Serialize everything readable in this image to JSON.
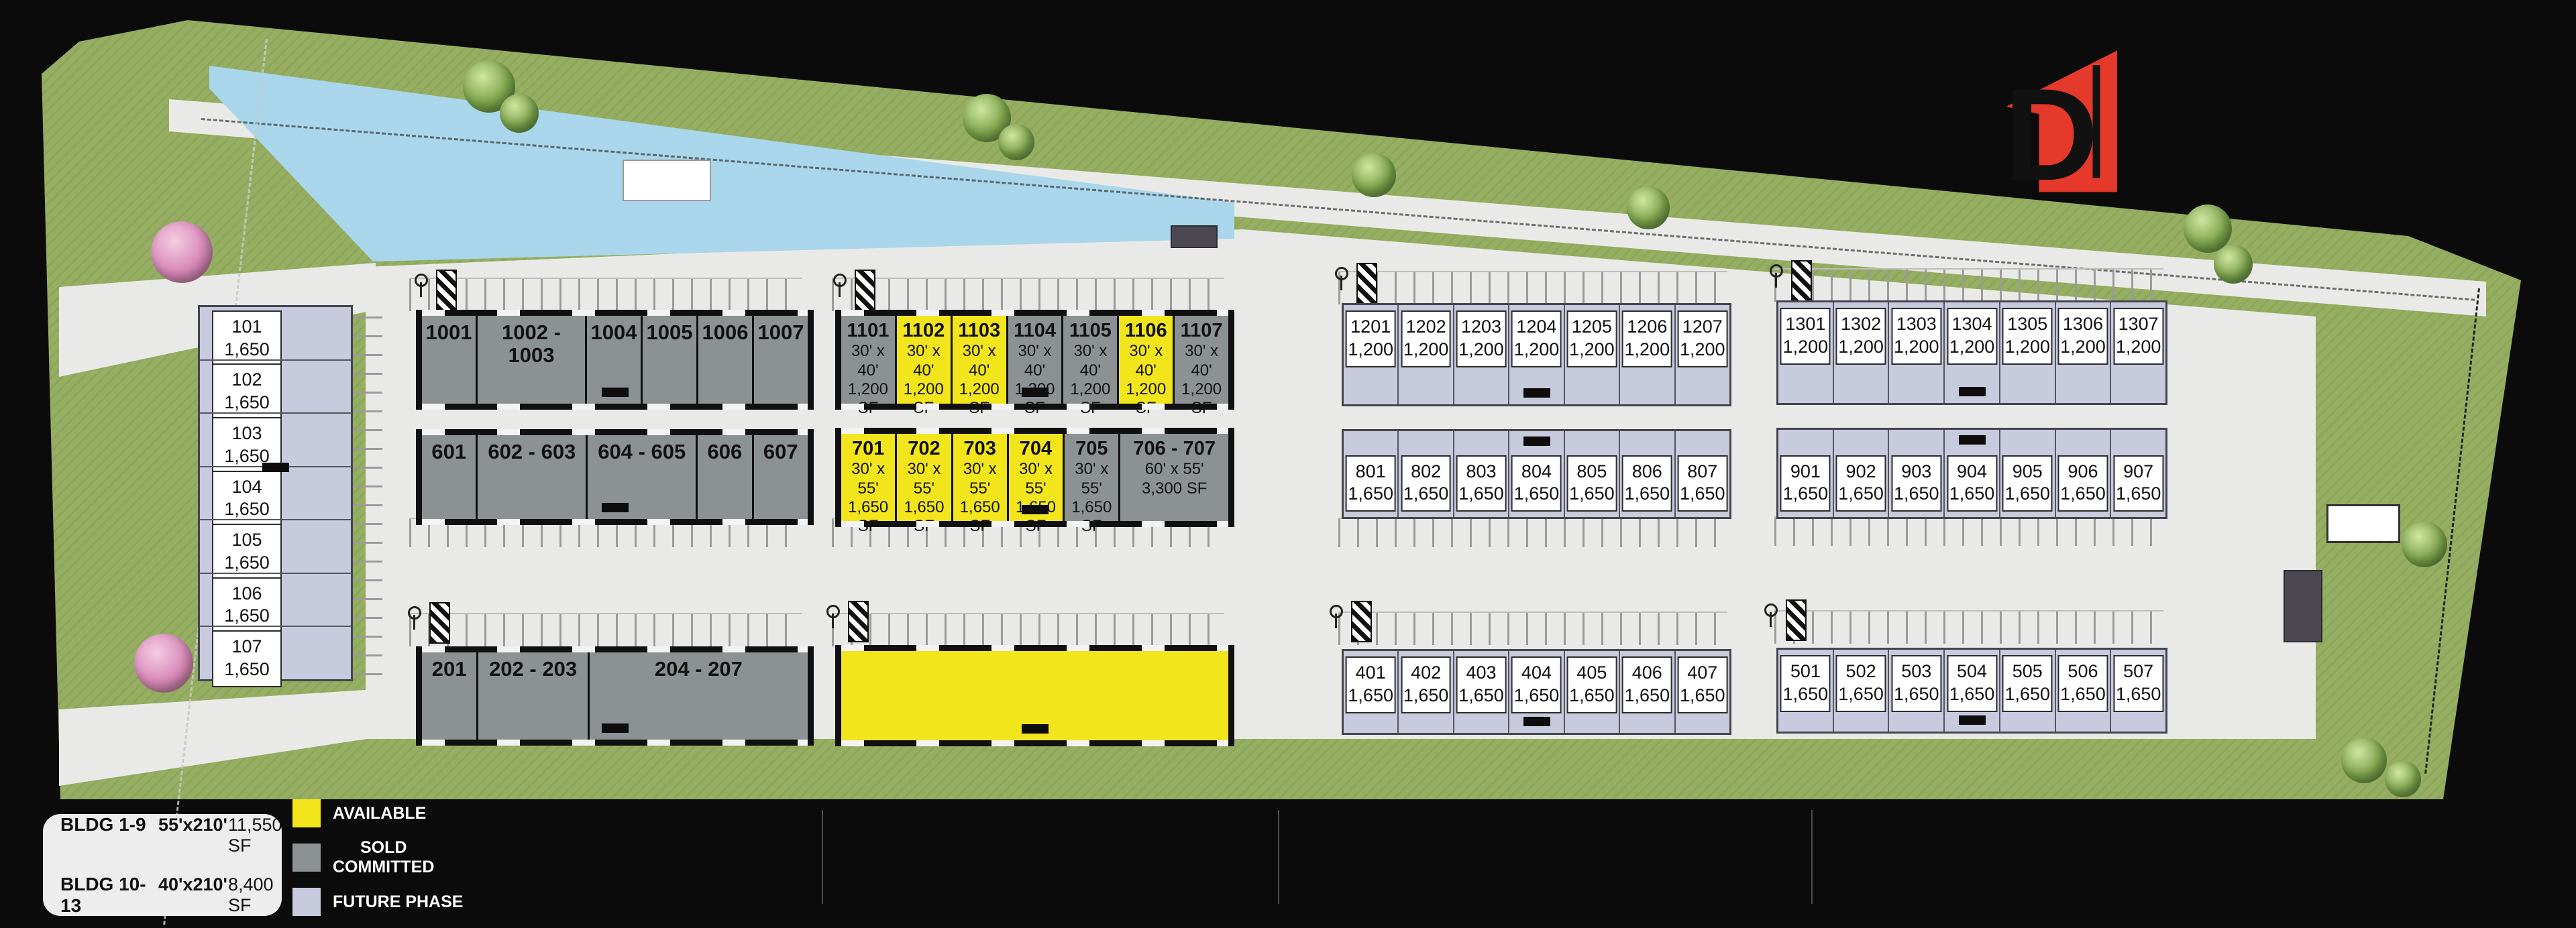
{
  "brand": {
    "name": "DACY",
    "subtitle": "Business Park"
  },
  "labels": {
    "pond": "POND",
    "street": "DACY LANE",
    "ossf": "OSSF",
    "sold_out": "SOLD OUT"
  },
  "legend": {
    "rows": [
      {
        "bldg": "BLDG 1-9",
        "dims": "55'x210'",
        "sf": "11,550 SF"
      },
      {
        "bldg": "BLDG 10-13",
        "dims": "40'x210'",
        "sf": "8,400 SF"
      }
    ],
    "statuses": [
      {
        "label": "AVAILABLE",
        "color": "#f2e51c"
      },
      {
        "label": "SOLD\nCOMMITTED",
        "color": "#8c9193"
      },
      {
        "label": "FUTURE PHASE",
        "color": "#c8cade"
      }
    ]
  },
  "phases": [
    {
      "name": "Phase 1",
      "status": "SOLD OUT"
    },
    {
      "name": "Phase 2",
      "status": "AVAILABLE"
    },
    {
      "name": "Phase 3",
      "status": "Q3 2026"
    },
    {
      "name": "Phase 4",
      "status": "Q1 2027"
    }
  ],
  "buildings": {
    "b1": {
      "label": "BLDG 1",
      "units": [
        {
          "num": "101",
          "sf": "1,650"
        },
        {
          "num": "102",
          "sf": "1,650"
        },
        {
          "num": "103",
          "sf": "1,650"
        },
        {
          "num": "104",
          "sf": "1,650"
        },
        {
          "num": "105",
          "sf": "1,650"
        },
        {
          "num": "106",
          "sf": "1,650"
        },
        {
          "num": "107",
          "sf": "1,650"
        }
      ]
    },
    "b10": {
      "label": "BLDG 10",
      "units": [
        {
          "num": "1001",
          "span": 1
        },
        {
          "num": "1002 - 1003",
          "span": 2
        },
        {
          "num": "1004",
          "span": 1
        },
        {
          "num": "1005",
          "span": 1
        },
        {
          "num": "1006",
          "span": 1
        },
        {
          "num": "1007",
          "span": 1
        }
      ]
    },
    "b11": {
      "label": "BLDG 11",
      "units": [
        {
          "num": "1101",
          "dims": "30' x 40'",
          "sf": "1,200 SF",
          "status": "sold"
        },
        {
          "num": "1102",
          "dims": "30' x 40'",
          "sf": "1,200 SF",
          "status": "avail"
        },
        {
          "num": "1103",
          "dims": "30' x 40'",
          "sf": "1,200 SF",
          "status": "avail"
        },
        {
          "num": "1104",
          "dims": "30' x 40'",
          "sf": "1,200 SF",
          "status": "sold"
        },
        {
          "num": "1105",
          "dims": "30' x 40'",
          "sf": "1,200 SF",
          "status": "sold"
        },
        {
          "num": "1106",
          "dims": "30' x 40'",
          "sf": "1,200 SF",
          "status": "avail"
        },
        {
          "num": "1107",
          "dims": "30' x 40'",
          "sf": "1,200 SF",
          "status": "sold"
        }
      ]
    },
    "b12": {
      "label": "BLDG 12",
      "units": [
        {
          "num": "1201",
          "sf": "1,200"
        },
        {
          "num": "1202",
          "sf": "1,200"
        },
        {
          "num": "1203",
          "sf": "1,200"
        },
        {
          "num": "1204",
          "sf": "1,200"
        },
        {
          "num": "1205",
          "sf": "1,200"
        },
        {
          "num": "1206",
          "sf": "1,200"
        },
        {
          "num": "1207",
          "sf": "1,200"
        }
      ]
    },
    "b13": {
      "label": "BLDG 13",
      "units": [
        {
          "num": "1301",
          "sf": "1,200"
        },
        {
          "num": "1302",
          "sf": "1,200"
        },
        {
          "num": "1303",
          "sf": "1,200"
        },
        {
          "num": "1304",
          "sf": "1,200"
        },
        {
          "num": "1305",
          "sf": "1,200"
        },
        {
          "num": "1306",
          "sf": "1,200"
        },
        {
          "num": "1307",
          "sf": "1,200"
        }
      ]
    },
    "b6": {
      "label": "BLDG 6",
      "units": [
        {
          "num": "601",
          "span": 1
        },
        {
          "num": "602 - 603",
          "span": 2
        },
        {
          "num": "604 - 605",
          "span": 2
        },
        {
          "num": "606",
          "span": 1
        },
        {
          "num": "607",
          "span": 1
        }
      ]
    },
    "b7": {
      "label": "BLDG 7",
      "units": [
        {
          "num": "701",
          "dims": "30' x 55'",
          "sf": "1,650 SF",
          "status": "avail"
        },
        {
          "num": "702",
          "dims": "30' x 55'",
          "sf": "1,650 SF",
          "status": "avail"
        },
        {
          "num": "703",
          "dims": "30' x 55'",
          "sf": "1,650 SF",
          "status": "avail"
        },
        {
          "num": "704",
          "dims": "30' x 55'",
          "sf": "1,650 SF",
          "status": "avail"
        },
        {
          "num": "705",
          "dims": "30' x 55'",
          "sf": "1,650 SF",
          "status": "sold"
        },
        {
          "num": "706 - 707",
          "dims": "60' x 55'",
          "sf": "3,300 SF",
          "status": "sold",
          "span": 2
        }
      ]
    },
    "b8": {
      "label": "BLDG 8",
      "units": [
        {
          "num": "801",
          "sf": "1,650"
        },
        {
          "num": "802",
          "sf": "1,650"
        },
        {
          "num": "803",
          "sf": "1,650"
        },
        {
          "num": "804",
          "sf": "1,650"
        },
        {
          "num": "805",
          "sf": "1,650"
        },
        {
          "num": "806",
          "sf": "1,650"
        },
        {
          "num": "807",
          "sf": "1,650"
        }
      ]
    },
    "b9": {
      "label": "BLDG 9",
      "units": [
        {
          "num": "901",
          "sf": "1,650"
        },
        {
          "num": "902",
          "sf": "1,650"
        },
        {
          "num": "903",
          "sf": "1,650"
        },
        {
          "num": "904",
          "sf": "1,650"
        },
        {
          "num": "905",
          "sf": "1,650"
        },
        {
          "num": "906",
          "sf": "1,650"
        },
        {
          "num": "907",
          "sf": "1,650"
        }
      ]
    },
    "b2": {
      "label": "BLDG 2",
      "units": [
        {
          "num": "201",
          "span": 1
        },
        {
          "num": "202 - 203",
          "span": 2
        },
        {
          "num": "204 - 207",
          "span": 4
        }
      ]
    },
    "b3": {
      "label": "BLDG 3",
      "range": "301 - 307",
      "dims": "210' x 55'",
      "sf": "11,550 SF"
    },
    "b4": {
      "label": "BLDG 4",
      "units": [
        {
          "num": "401",
          "sf": "1,650"
        },
        {
          "num": "402",
          "sf": "1,650"
        },
        {
          "num": "403",
          "sf": "1,650"
        },
        {
          "num": "404",
          "sf": "1,650"
        },
        {
          "num": "405",
          "sf": "1,650"
        },
        {
          "num": "406",
          "sf": "1,650"
        },
        {
          "num": "407",
          "sf": "1,650"
        }
      ]
    },
    "b5": {
      "label": "BLDG 5",
      "units": [
        {
          "num": "501",
          "sf": "1,650"
        },
        {
          "num": "502",
          "sf": "1,650"
        },
        {
          "num": "503",
          "sf": "1,650"
        },
        {
          "num": "504",
          "sf": "1,650"
        },
        {
          "num": "505",
          "sf": "1,650"
        },
        {
          "num": "506",
          "sf": "1,650"
        },
        {
          "num": "507",
          "sf": "1,650"
        }
      ]
    }
  }
}
